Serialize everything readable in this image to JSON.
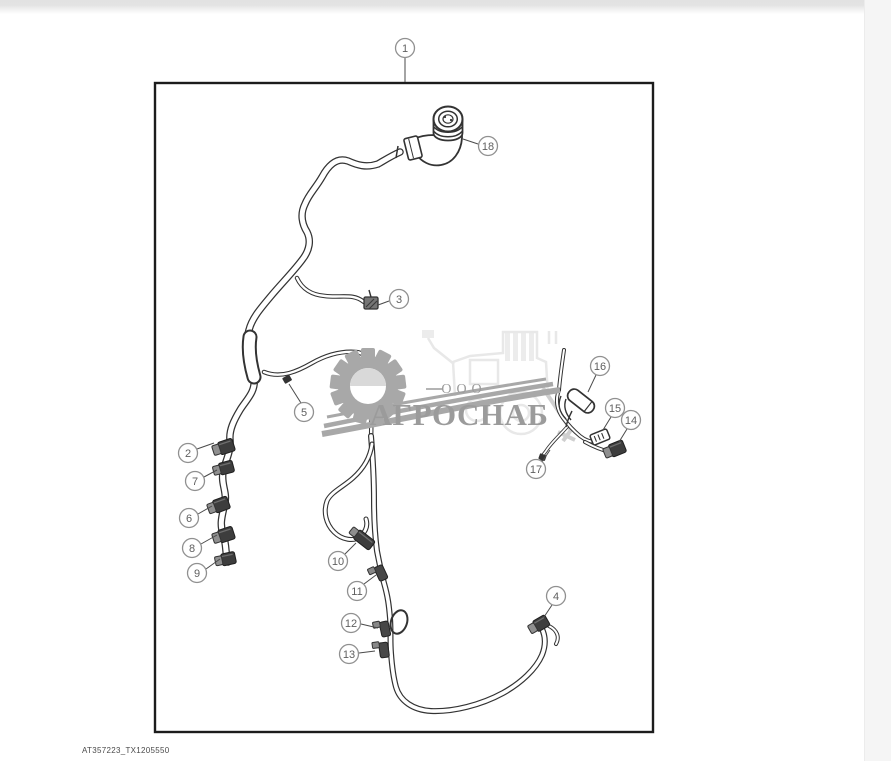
{
  "page": {
    "figure_code": "AT357223_TX1205550",
    "background": "#ffffff",
    "top_bar_color": "#e3e3e3",
    "right_strip_color": "#f5f5f5"
  },
  "watermark": {
    "company_prefix": "ООО",
    "company_name": "АГРОСНАБ",
    "text_color": "#9b9b9b",
    "gear_color": "#a8a8a8",
    "machine_color": "#e8e8e8"
  },
  "diagram": {
    "type": "wiring-harness-parts-diagram",
    "ink_color": "#333333",
    "border_color": "#1c1c1c",
    "callout_ring_color": "#909090",
    "callout_text_color": "#5f5f5f",
    "callouts": [
      {
        "label": "1",
        "cx": 405,
        "cy": 48,
        "leader": [
          405,
          58,
          405,
          82
        ]
      },
      {
        "label": "2",
        "cx": 188,
        "cy": 453,
        "leader": [
          197,
          449,
          214,
          443
        ]
      },
      {
        "label": "3",
        "cx": 399,
        "cy": 299,
        "leader": [
          389,
          301,
          378,
          305
        ]
      },
      {
        "label": "4",
        "cx": 556,
        "cy": 596,
        "leader": [
          552,
          605,
          544,
          617
        ]
      },
      {
        "label": "5",
        "cx": 304,
        "cy": 412,
        "leader": [
          301,
          403,
          289,
          384
        ]
      },
      {
        "label": "6",
        "cx": 189,
        "cy": 518,
        "leader": [
          198,
          514,
          212,
          506
        ]
      },
      {
        "label": "7",
        "cx": 195,
        "cy": 481,
        "leader": [
          204,
          477,
          217,
          470
        ]
      },
      {
        "label": "8",
        "cx": 192,
        "cy": 548,
        "leader": [
          201,
          544,
          217,
          535
        ]
      },
      {
        "label": "9",
        "cx": 197,
        "cy": 573,
        "leader": [
          206,
          569,
          220,
          559
        ]
      },
      {
        "label": "10",
        "cx": 338,
        "cy": 561,
        "leader": [
          345,
          554,
          356,
          543
        ]
      },
      {
        "label": "11",
        "cx": 357,
        "cy": 591,
        "leader": [
          364,
          584,
          376,
          575
        ]
      },
      {
        "label": "12",
        "cx": 351,
        "cy": 623,
        "leader": [
          361,
          624,
          378,
          628
        ]
      },
      {
        "label": "13",
        "cx": 349,
        "cy": 654,
        "leader": [
          359,
          653,
          375,
          651
        ]
      },
      {
        "label": "14",
        "cx": 631,
        "cy": 420,
        "leader": [
          627,
          429,
          619,
          442
        ]
      },
      {
        "label": "15",
        "cx": 615,
        "cy": 408,
        "leader": [
          611,
          417,
          603,
          430
        ]
      },
      {
        "label": "16",
        "cx": 600,
        "cy": 366,
        "leader": [
          596,
          375,
          588,
          392
        ]
      },
      {
        "label": "17",
        "cx": 536,
        "cy": 469,
        "leader": [
          542,
          462,
          550,
          450
        ]
      },
      {
        "label": "18",
        "cx": 488,
        "cy": 146,
        "leader": [
          478,
          144,
          463,
          139
        ]
      }
    ]
  }
}
